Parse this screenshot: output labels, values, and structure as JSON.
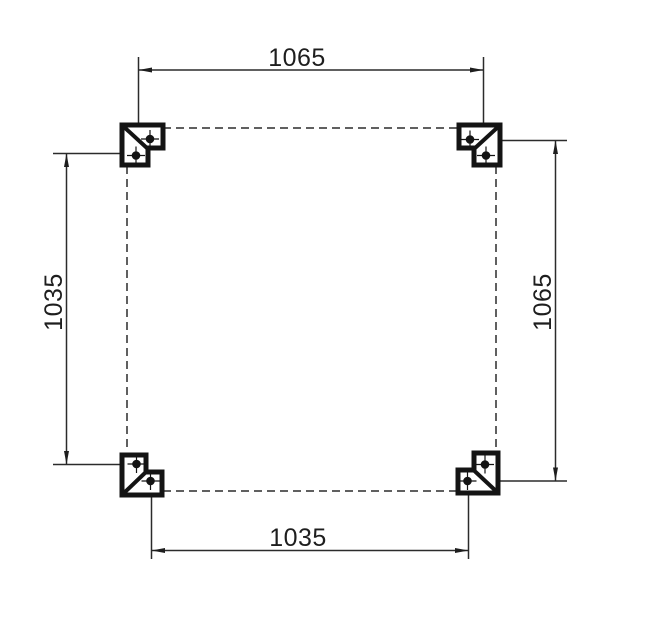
{
  "drawing": {
    "type": "technical-dimension-plan",
    "background_color": "#ffffff",
    "line_color": "#2b2b2b",
    "bracket_color": "#141414",
    "label_color": "#1e1e1e",
    "dimensions": {
      "top": {
        "value": "1065",
        "orientation": "horizontal",
        "position": "top"
      },
      "right": {
        "value": "1065",
        "orientation": "vertical",
        "position": "right"
      },
      "left": {
        "value": "1035",
        "orientation": "vertical",
        "position": "left"
      },
      "bottom": {
        "value": "1035",
        "orientation": "horizontal",
        "position": "bottom"
      }
    },
    "corner_brackets": [
      {
        "position": "top-left",
        "bolt_holes": 2
      },
      {
        "position": "top-right",
        "bolt_holes": 2
      },
      {
        "position": "bottom-left",
        "bolt_holes": 2
      },
      {
        "position": "bottom-right",
        "bolt_holes": 2
      }
    ],
    "outline_style": "dashed-square"
  }
}
